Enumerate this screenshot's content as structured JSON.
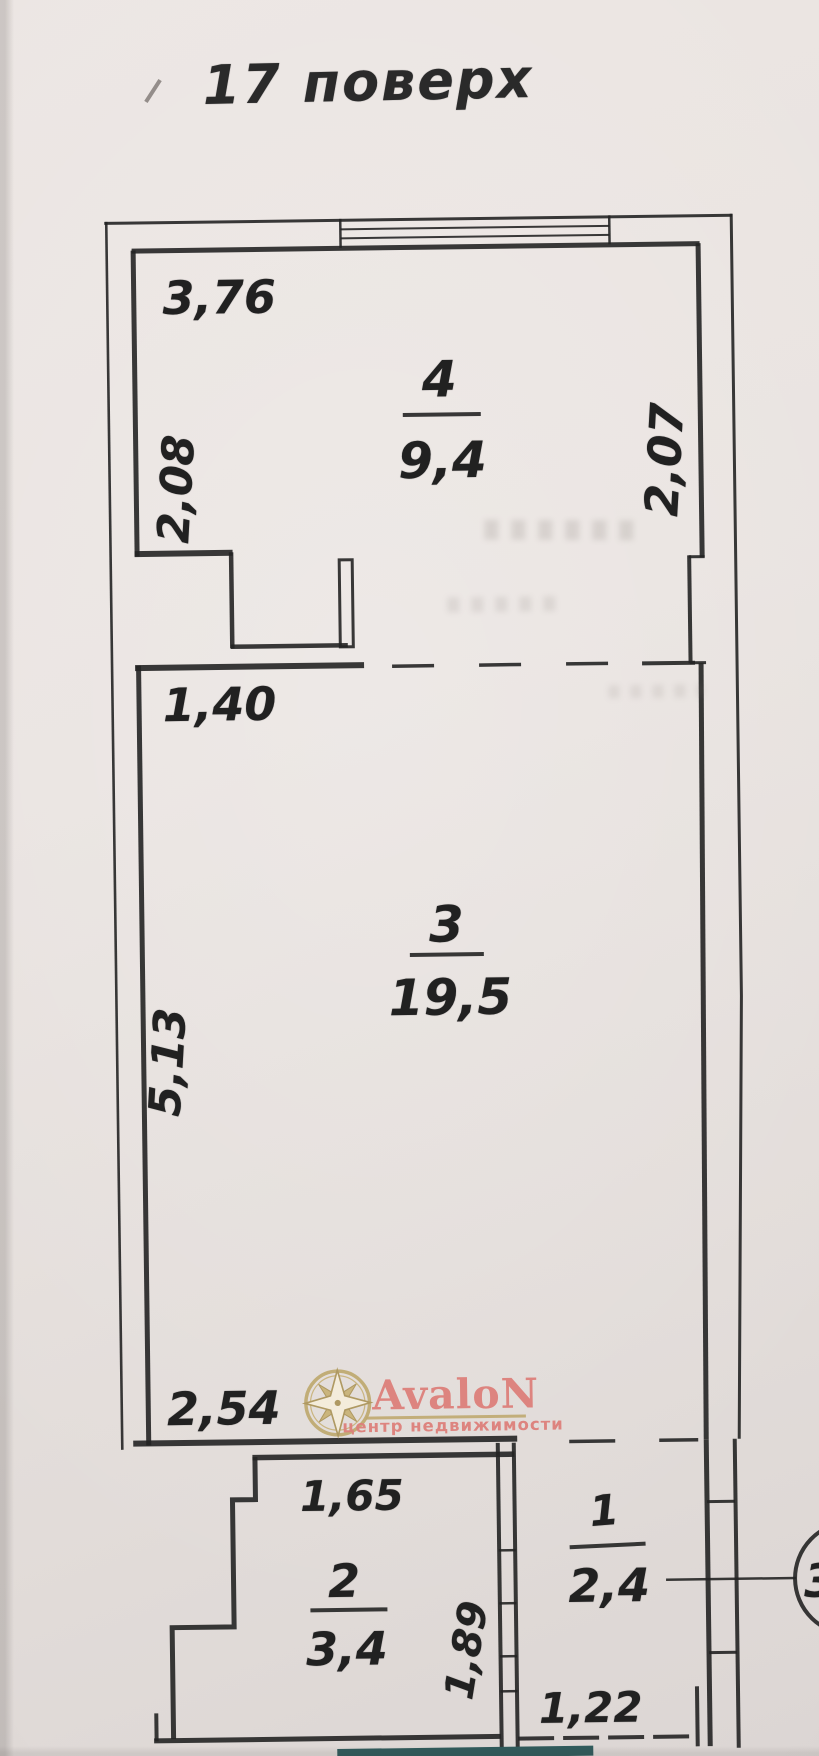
{
  "title": "17 поверх",
  "rooms": {
    "r4": {
      "number": "4",
      "area": "9,4"
    },
    "r3": {
      "number": "3",
      "area": "19,5"
    },
    "r2": {
      "number": "2",
      "area": "3,4"
    },
    "r1": {
      "number": "1",
      "area": "2,4"
    }
  },
  "dimensions": {
    "top_left_width": "3,76",
    "left_upper_height": "2,08",
    "right_upper_height": "2,07",
    "opening_width": "1,40",
    "left_main_height": "5,13",
    "bottom_width": "2,54",
    "room2_width": "1,65",
    "room2_height": "1,89",
    "room1_width": "1,22"
  },
  "callout": {
    "number": "3"
  },
  "watermark": {
    "brand": "AvaloN",
    "tagline": "центр недвижимости",
    "icon": "compass-rose-icon"
  },
  "colors": {
    "ink": "#242424",
    "paper": "#e9e3e0",
    "logo_pink": "#dd807b",
    "logo_gold": "#bfa96f",
    "bottom_strip_teal": "#305b5c"
  }
}
